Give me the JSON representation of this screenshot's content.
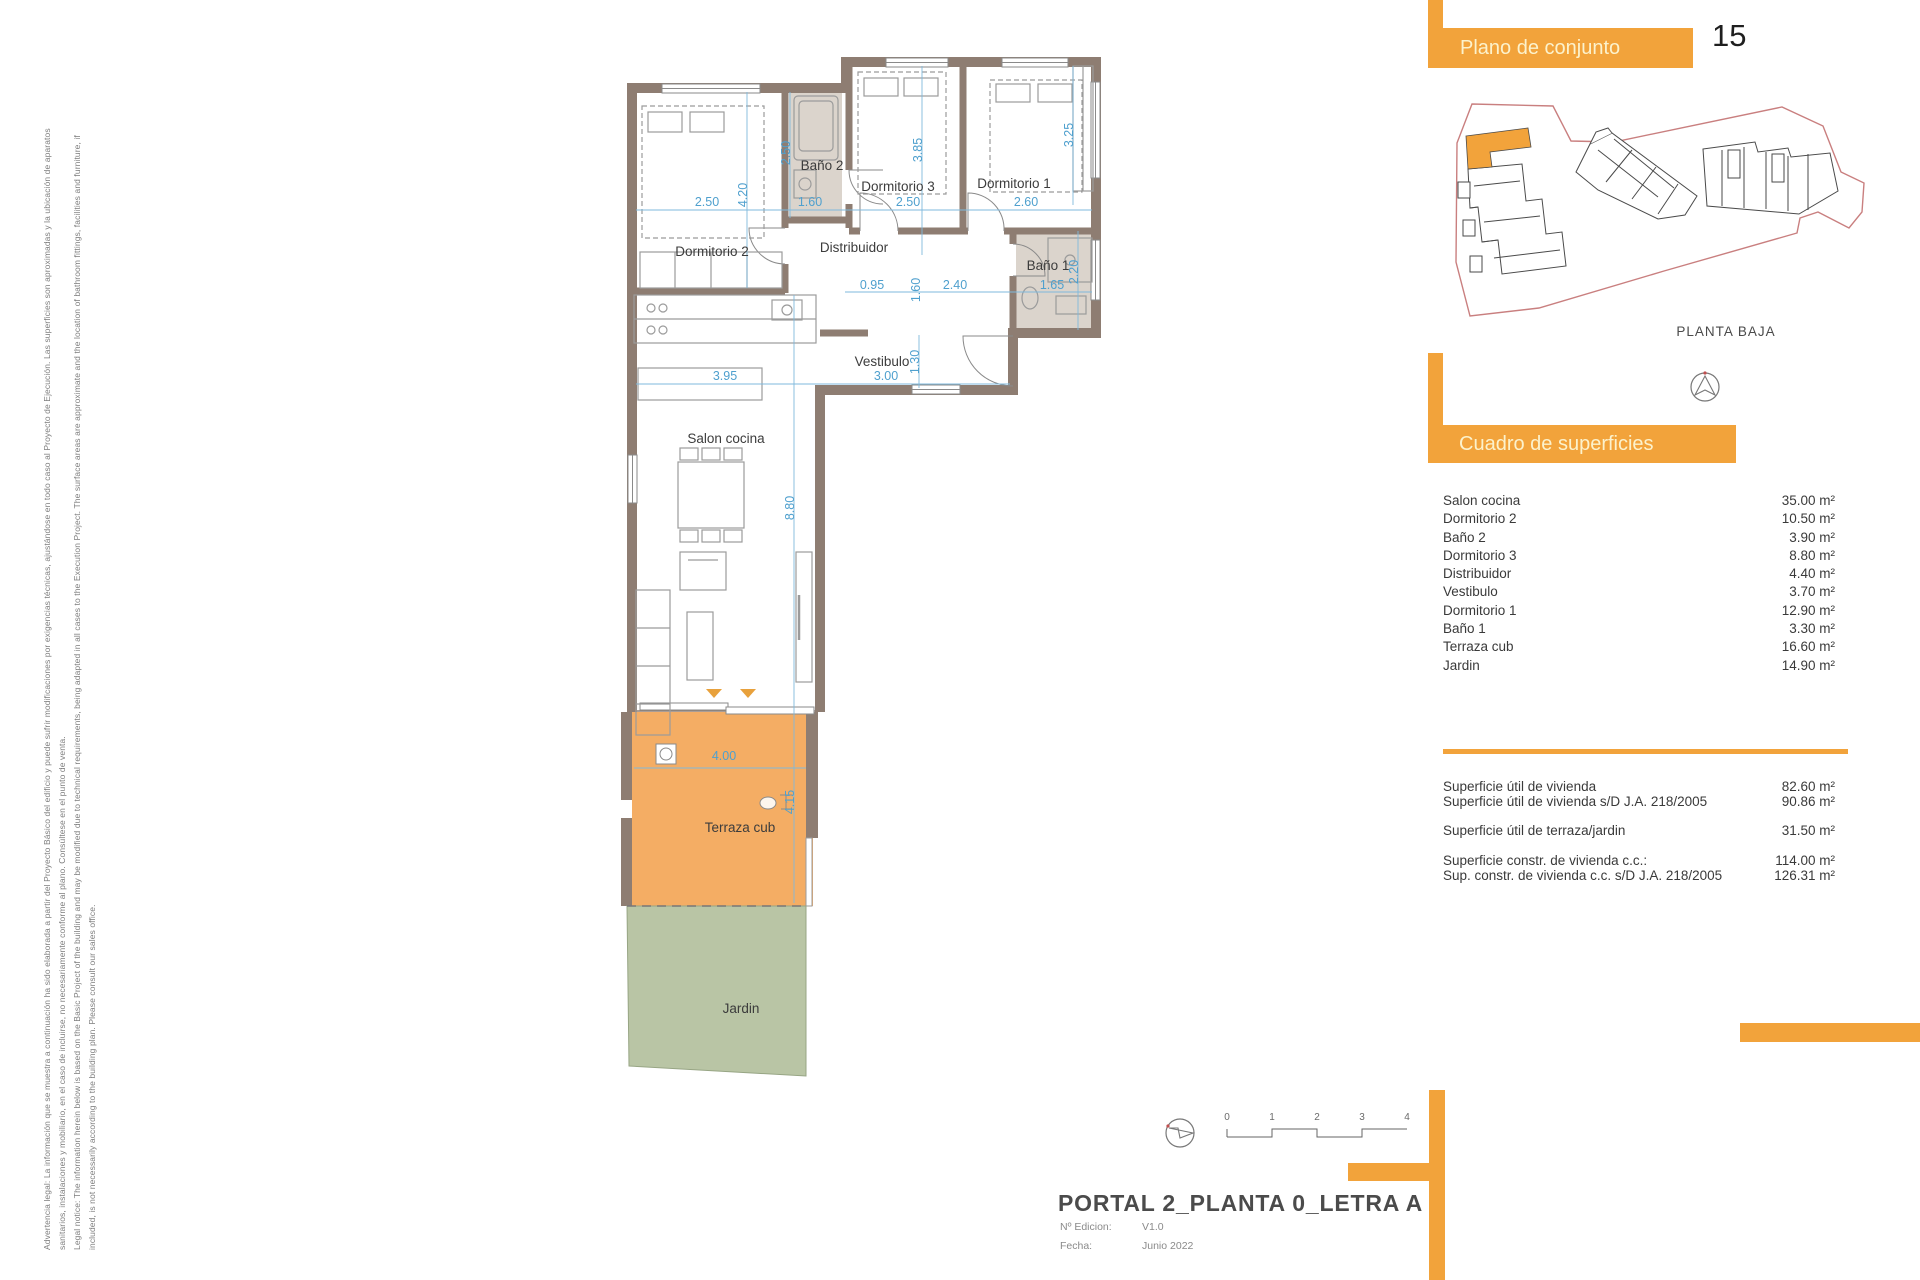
{
  "colors": {
    "accent": "#F2A33B",
    "header_text": "#FCF2CC",
    "terrace_fill": "#F4AD64",
    "garden_fill": "#B9C5A5",
    "wall": "#8E7D72",
    "bath_floor": "#DBD4CC",
    "dimension_blue": "#4FA0CE",
    "site_boundary_red": "#C97F7F"
  },
  "legal": {
    "line1": "Advertencia legal: La información que se muestra a continuación ha sido elaborada a partir del Proyecto Básico del edificio y puede sufrir modificaciones por exigencias técnicas, ajustándose en todo caso al Proyecto de Ejecución. Las superficies son aproximadas y la ubicación de aparatos",
    "line2": "sanitarios, instalaciones y mobiliario, en el caso de incluirse, no necesariamente conforme al plano. Consúltese en el punto de venta.",
    "line3": "Legal notice: The information herein below is based on the Basic Project of the building and may be modified due to technical requirements, being adapted in all cases to the Execution Project. The surface areas are approximate and the location of bathroom fittings, facilities and furniture, if",
    "line4": "included, is not necessarily according to the building plan. Please consult our sales office."
  },
  "site_panel": {
    "title": "Plano de conjunto",
    "page_number": "15",
    "floor_label": "PLANTA BAJA"
  },
  "surfaces_panel": {
    "title": "Cuadro de superficies",
    "rows": [
      {
        "label": "Salon cocina",
        "value": "35.00 m²"
      },
      {
        "label": "Dormitorio 2",
        "value": "10.50 m²"
      },
      {
        "label": "Baño 2",
        "value": "3.90 m²"
      },
      {
        "label": "Dormitorio 3",
        "value": "8.80 m²"
      },
      {
        "label": "Distribuidor",
        "value": "4.40 m²"
      },
      {
        "label": "Vestibulo",
        "value": "3.70 m²"
      },
      {
        "label": "Dormitorio 1",
        "value": "12.90 m²"
      },
      {
        "label": "Baño 1",
        "value": "3.30 m²"
      },
      {
        "label": "Terraza cub",
        "value": "16.60 m²"
      },
      {
        "label": "Jardin",
        "value": "14.90 m²"
      }
    ],
    "totals": [
      {
        "label": "Superficie útil de vivienda",
        "value": "82.60 m²"
      },
      {
        "label": "Superficie útil de vivienda s/D J.A. 218/2005",
        "value": "90.86 m²"
      },
      {
        "label": "Superficie útil de terraza/jardin",
        "value": "31.50 m²"
      },
      {
        "label": "Superficie constr. de vivienda c.c.:",
        "value": "114.00 m²"
      },
      {
        "label": "Sup. constr. de vivienda c.c. s/D J.A. 218/2005",
        "value": "126.31 m²"
      }
    ]
  },
  "title_block": {
    "title": "PORTAL 2_PLANTA 0_LETRA A",
    "edition_label": "Nº Edicion:",
    "edition_value": "V1.0",
    "date_label": "Fecha:",
    "date_value": "Junio 2022"
  },
  "scale_bar": {
    "ticks": [
      "0",
      "1",
      "2",
      "3",
      "4"
    ]
  },
  "plan": {
    "labels": {
      "dorm2": "Dormitorio 2",
      "bath2": "Baño 2",
      "dorm3": "Dormitorio 3",
      "dorm1": "Dormitorio 1",
      "distribuidor": "Distribuidor",
      "bath1": "Baño 1",
      "vestibulo": "Vestibulo",
      "salon": "Salon cocina",
      "terrace": "Terraza cub",
      "garden": "Jardin"
    },
    "dims": {
      "dorm2_w": "2.50",
      "dorm2_h": "4.20",
      "bath2_h": "2.50",
      "bath2_w": "1.60",
      "dorm3_h": "3.85",
      "dorm3_w": "2.50",
      "dorm1_h": "3.25",
      "dorm1_w": "2.60",
      "hall_a": "0.95",
      "hall_b": "2.40",
      "hall_c": "1.60",
      "bath1_w": "1.65",
      "bath1_h": "2.20",
      "salon_w": "3.95",
      "vest_w": "3.00",
      "vest_h": "1.30",
      "salon_h": "8.80",
      "terrace_w": "4.00",
      "terrace_h": "4.15"
    }
  }
}
